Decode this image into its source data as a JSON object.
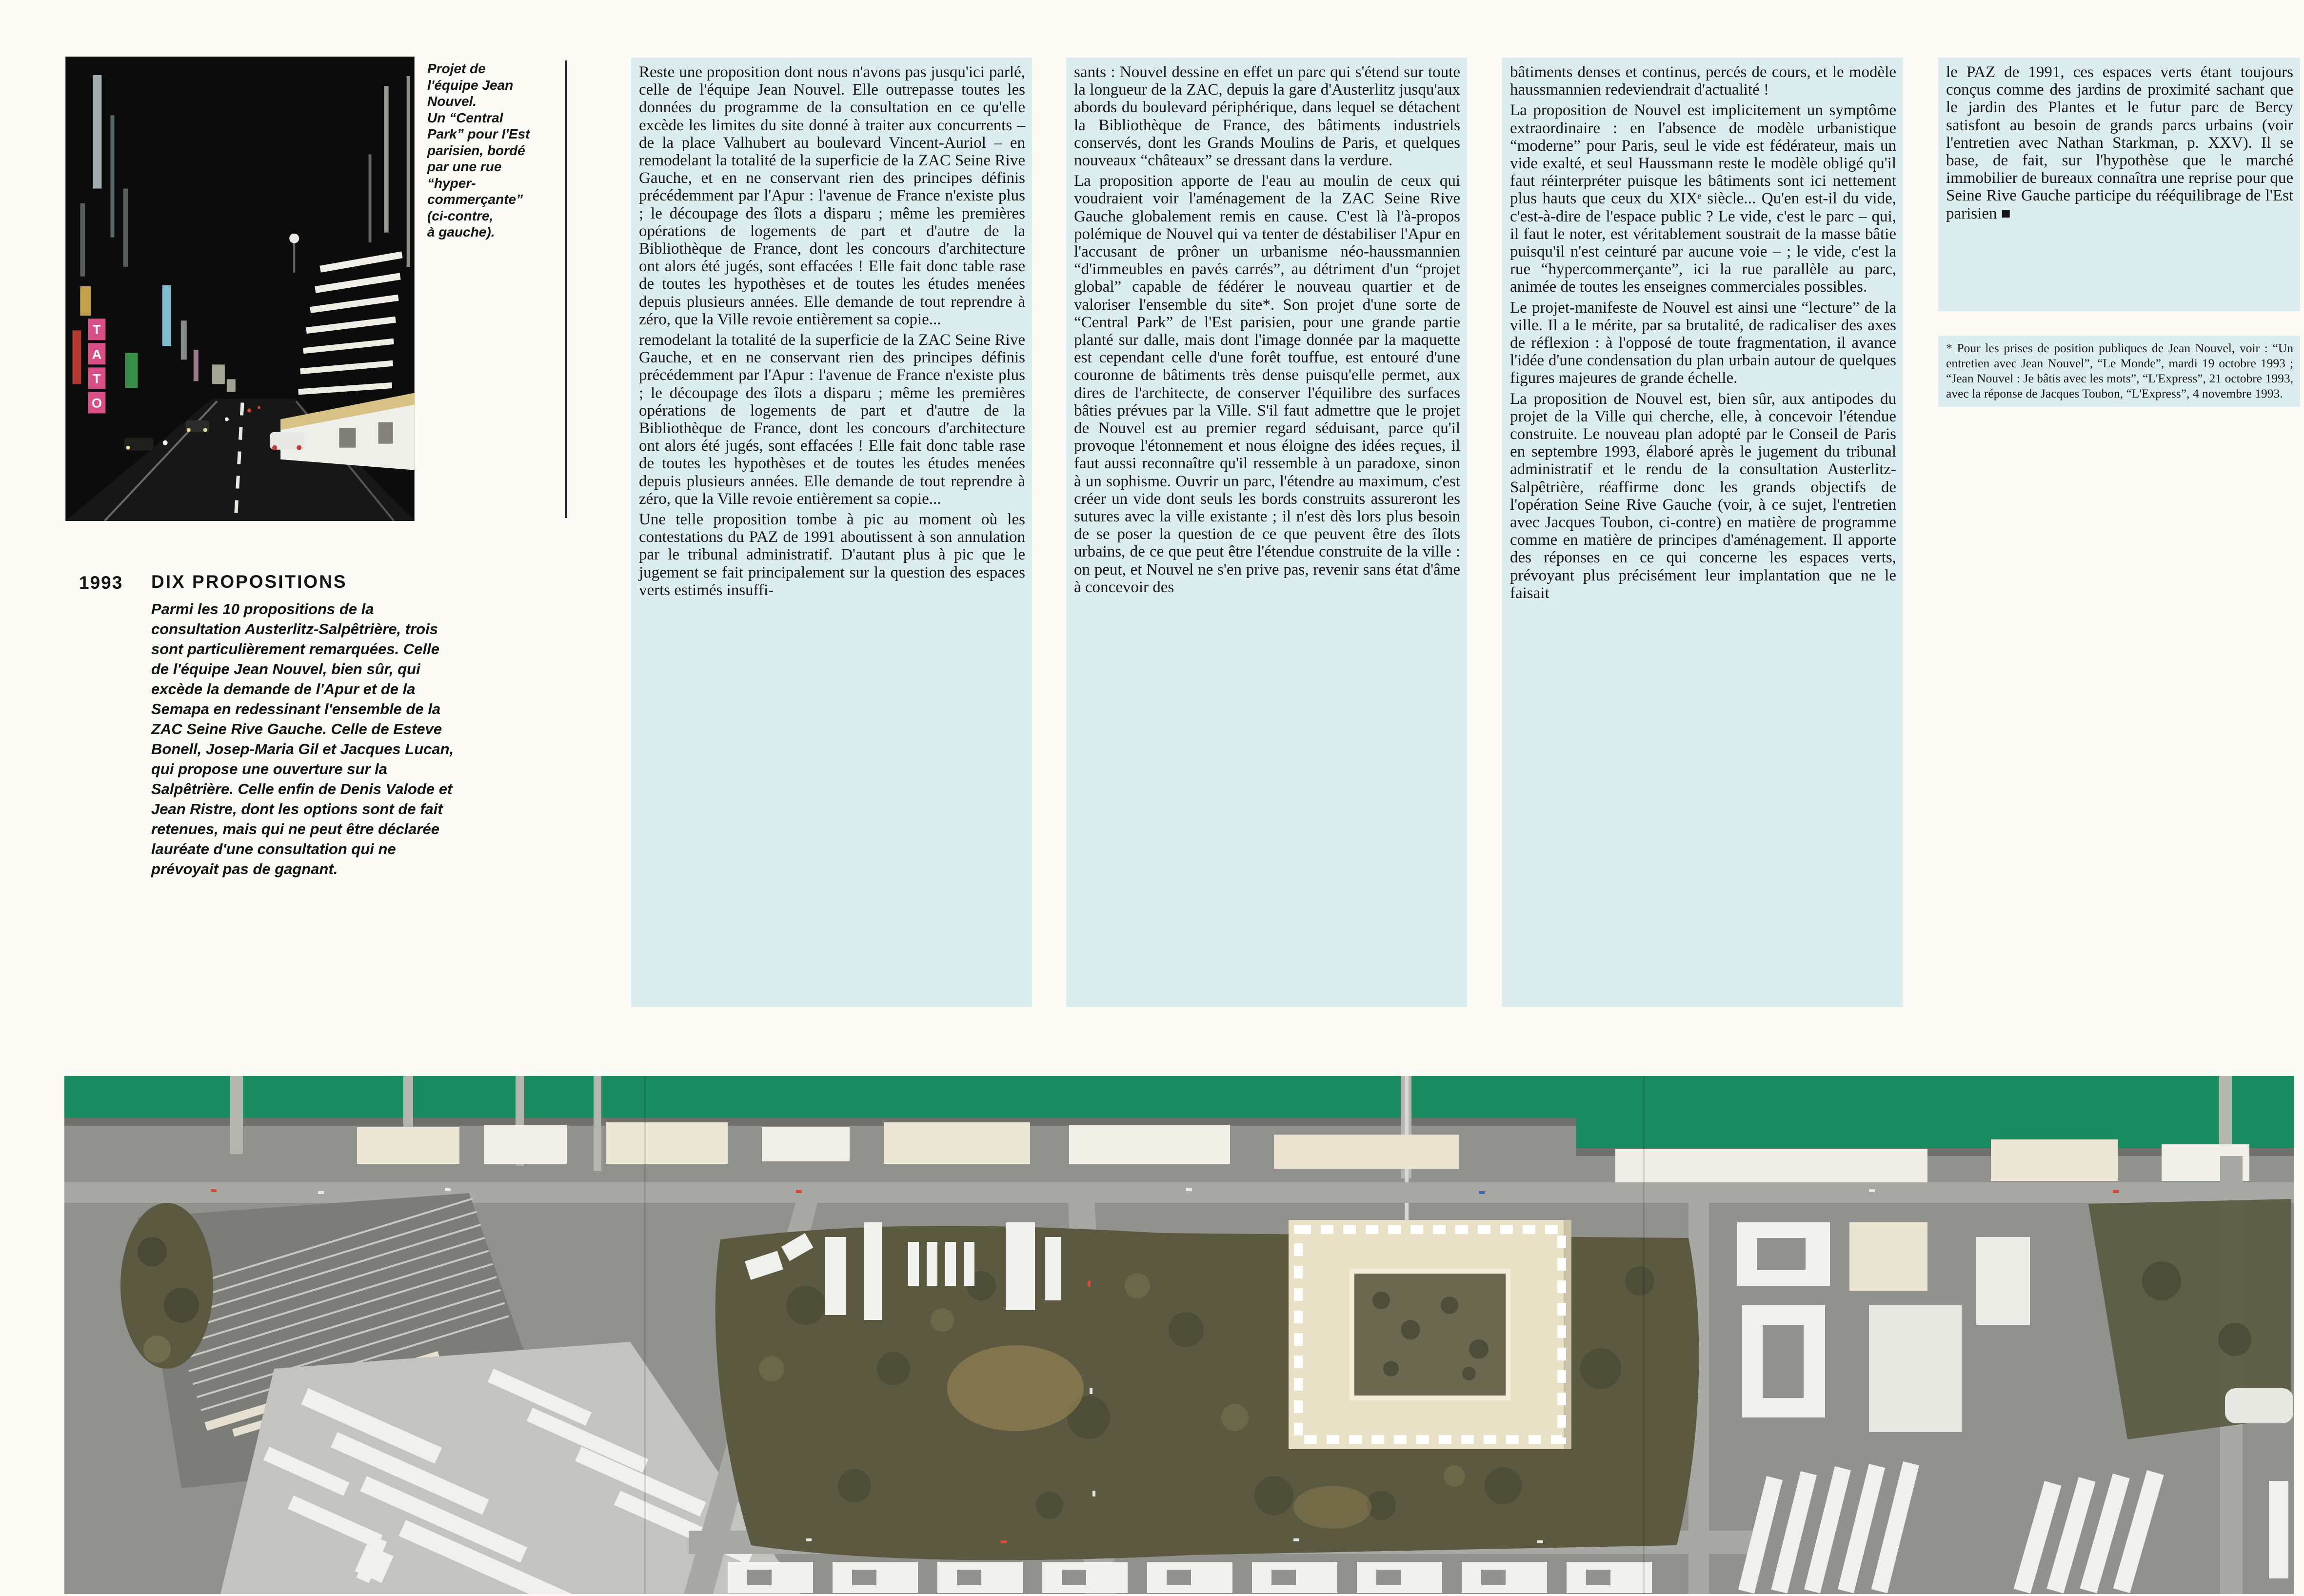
{
  "caption": {
    "text": "Projet de\nl'équipe Jean\nNouvel.\nUn “Central\nPark” pour l'Est\nparisien, bordé\npar une rue\n“hyper-\ncommerçante”\n(ci-contre,\nà gauche)."
  },
  "sidebar": {
    "year": "1993",
    "title": "DIX PROPOSITIONS",
    "body": "Parmi les 10 propositions de la consultation Austerlitz-Salpêtrière, trois sont particulièrement remarquées. Celle de l'équipe Jean Nouvel, bien sûr, qui excède la demande de l'Apur et de la Semapa en redessinant l'ensemble de la ZAC Seine Rive Gauche. Celle de Esteve Bonell, Josep-Maria Gil et Jacques Lucan, qui propose une ouverture sur la Salpêtrière. Celle enfin de Denis Valode et Jean Ristre, dont les options sont de fait retenues, mais qui ne peut être déclarée lauréate d'une consultation qui ne prévoyait pas de gagnant."
  },
  "columns": [
    {
      "paragraphs": [
        "Reste une proposition dont nous n'avons pas jusqu'ici parlé, celle de l'équipe Jean Nouvel. Elle outrepasse toutes les données du programme de la consultation en ce qu'elle excède les limites du site donné à traiter aux concurrents – de la place Valhubert au boulevard Vincent-Auriol – en remodelant la totalité de la superficie de la ZAC Seine Rive Gauche, et en ne conservant rien des principes définis précédemment par l'Apur : l'avenue de France n'existe plus ; le découpage des îlots a disparu ; même les premières opérations de logements de part et d'autre de la Bibliothèque de France, dont les concours d'architecture ont alors été jugés, sont effacées ! Elle fait donc table rase de toutes les hypothèses et de toutes les études menées depuis plusieurs années. Elle demande de tout reprendre à zéro, que la Ville revoie entièrement sa copie...",
        "remodelant la totalité de la superficie de la ZAC Seine Rive Gauche, et en ne conservant rien des principes définis précédemment par l'Apur : l'avenue de France n'existe plus ; le découpage des îlots a disparu ; même les premières opérations de logements de part et d'autre de la Bibliothèque de France, dont les concours d'architecture ont alors été jugés, sont effacées ! Elle fait donc table rase de toutes les hypothèses et de toutes les études menées depuis plusieurs années. Elle demande de tout reprendre à zéro, que la Ville revoie entièrement sa copie...",
        "Une telle proposition tombe à pic au moment où les contestations du PAZ de 1991 aboutissent à son annulation par le tribunal administratif. D'autant plus à pic que le jugement se fait principalement sur la question des espaces verts estimés insuffi-"
      ]
    },
    {
      "paragraphs": [
        "sants : Nouvel dessine en effet un parc qui s'étend sur toute la longueur de la ZAC, depuis la gare d'Austerlitz jusqu'aux abords du boulevard périphérique, dans lequel se détachent la Bibliothèque de France, des bâtiments industriels conservés, dont les Grands Moulins de Paris, et quelques nouveaux “châteaux” se dressant dans la verdure.",
        "La proposition apporte de l'eau au moulin de ceux qui voudraient voir l'aménagement de la ZAC Seine Rive Gauche globalement remis en cause. C'est là l'à-propos polémique de Nouvel qui va tenter de déstabiliser l'Apur en l'accusant de prôner un urbanisme néo-haussmannien “d'immeubles en pavés carrés”, au détriment d'un “projet global” capable de fédérer le nouveau quartier et de valoriser l'ensemble du site*. Son projet d'une sorte de “Central Park” de l'Est parisien, pour une grande partie planté sur dalle, mais dont l'image donnée par la maquette est cependant celle d'une forêt touffue, est entouré d'une couronne de bâtiments très dense puisqu'elle permet, aux dires de l'architecte, de conserver l'équilibre des surfaces bâties prévues par la Ville. S'il faut admettre que le projet de Nouvel est au premier regard séduisant, parce qu'il provoque l'étonnement et nous éloigne des idées reçues, il faut aussi reconnaître qu'il ressemble à un paradoxe, sinon à un sophisme. Ouvrir un parc, l'étendre au maximum, c'est créer un vide dont seuls les bords construits assureront les sutures avec la ville existante ; il n'est dès lors plus besoin de se poser la question de ce que peuvent être des îlots urbains, de ce que peut être l'étendue construite de la ville : on peut, et Nouvel ne s'en prive pas, revenir sans état d'âme à concevoir des"
      ]
    },
    {
      "paragraphs": [
        "bâtiments denses et continus, percés de cours, et le modèle haussmannien redeviendrait d'actualité !",
        "La proposition de Nouvel est implicitement un symptôme extraordinaire : en l'absence de modèle urbanistique “moderne” pour Paris, seul le vide est fédérateur, mais un vide exalté, et seul Haussmann reste le modèle obligé qu'il faut réinterpréter puisque les bâtiments sont ici nettement plus hauts que ceux du XIXᵉ siècle... Qu'en est-il du vide, c'est-à-dire de l'espace public ? Le vide, c'est le parc – qui, il faut le noter, est véritablement soustrait de la masse bâtie puisqu'il n'est ceinturé par aucune voie – ; le vide, c'est la rue “hypercommerçante”, ici la rue parallèle au parc, animée de toutes les enseignes commerciales possibles.",
        "Le projet-manifeste de Nouvel est ainsi une “lecture” de la ville. Il a le mérite, par sa brutalité, de radicaliser des axes de réflexion : à l'opposé de toute fragmentation, il avance l'idée d'une condensation du plan urbain autour de quelques figures majeures de grande échelle.",
        "La proposition de Nouvel est, bien sûr, aux antipodes du projet de la Ville qui cherche, elle, à concevoir l'étendue construite. Le nouveau plan adopté par le Conseil de Paris en septembre 1993, élaboré après le jugement du tribunal administratif et le rendu de la consultation Austerlitz-Salpêtrière, réaffirme donc les grands objectifs de l'opération Seine Rive Gauche (voir, à ce sujet, l'entretien avec Jacques Toubon, ci-contre) en matière de programme comme en matière de principes d'aménagement. Il apporte des réponses en ce qui concerne les espaces verts, prévoyant plus précisément leur implantation que ne le faisait"
      ]
    },
    {
      "paragraphs": [
        "le PAZ de 1991, ces espaces verts étant toujours conçus comme des jardins de proximité sachant que le jardin des Plantes et le futur parc de Bercy satisfont au besoin de grands parcs urbains (voir l'entretien avec Nathan Starkman, p. XXV). Il se base, de fait, sur l'hypothèse que le marché immobilier de bureaux connaîtra une reprise pour que Seine Rive Gauche participe du rééquilibrage de l'Est parisien ■"
      ]
    }
  ],
  "footnote": "* Pour les prises de position publiques de Jean Nouvel, voir : “Un entretien avec Jean Nouvel”, “Le Monde”, mardi 19 octobre 1993 ; “Jean Nouvel : Je bâtis avec les mots”, “L'Express”, 21 octobre 1993, avec la réponse de Jacques Toubon, “L'Express”, 4 novembre 1993.",
  "photo": {
    "sign_letters": [
      "T",
      "A",
      "T",
      "O"
    ]
  },
  "colors": {
    "page": "#fbfaf5",
    "highlight": "#dcedef",
    "text": "#171614",
    "river": "#1a8a61",
    "park": "#5b5a41",
    "park-dark": "#4a4936",
    "park-light": "#6f6d4d",
    "model-base": "#91918d",
    "street": "#a8a8a4",
    "cream": "#e9e1c6",
    "white-block": "#f0f0ec",
    "photo-black": "#0c0c0c",
    "neon-pink": "#d84f86"
  }
}
